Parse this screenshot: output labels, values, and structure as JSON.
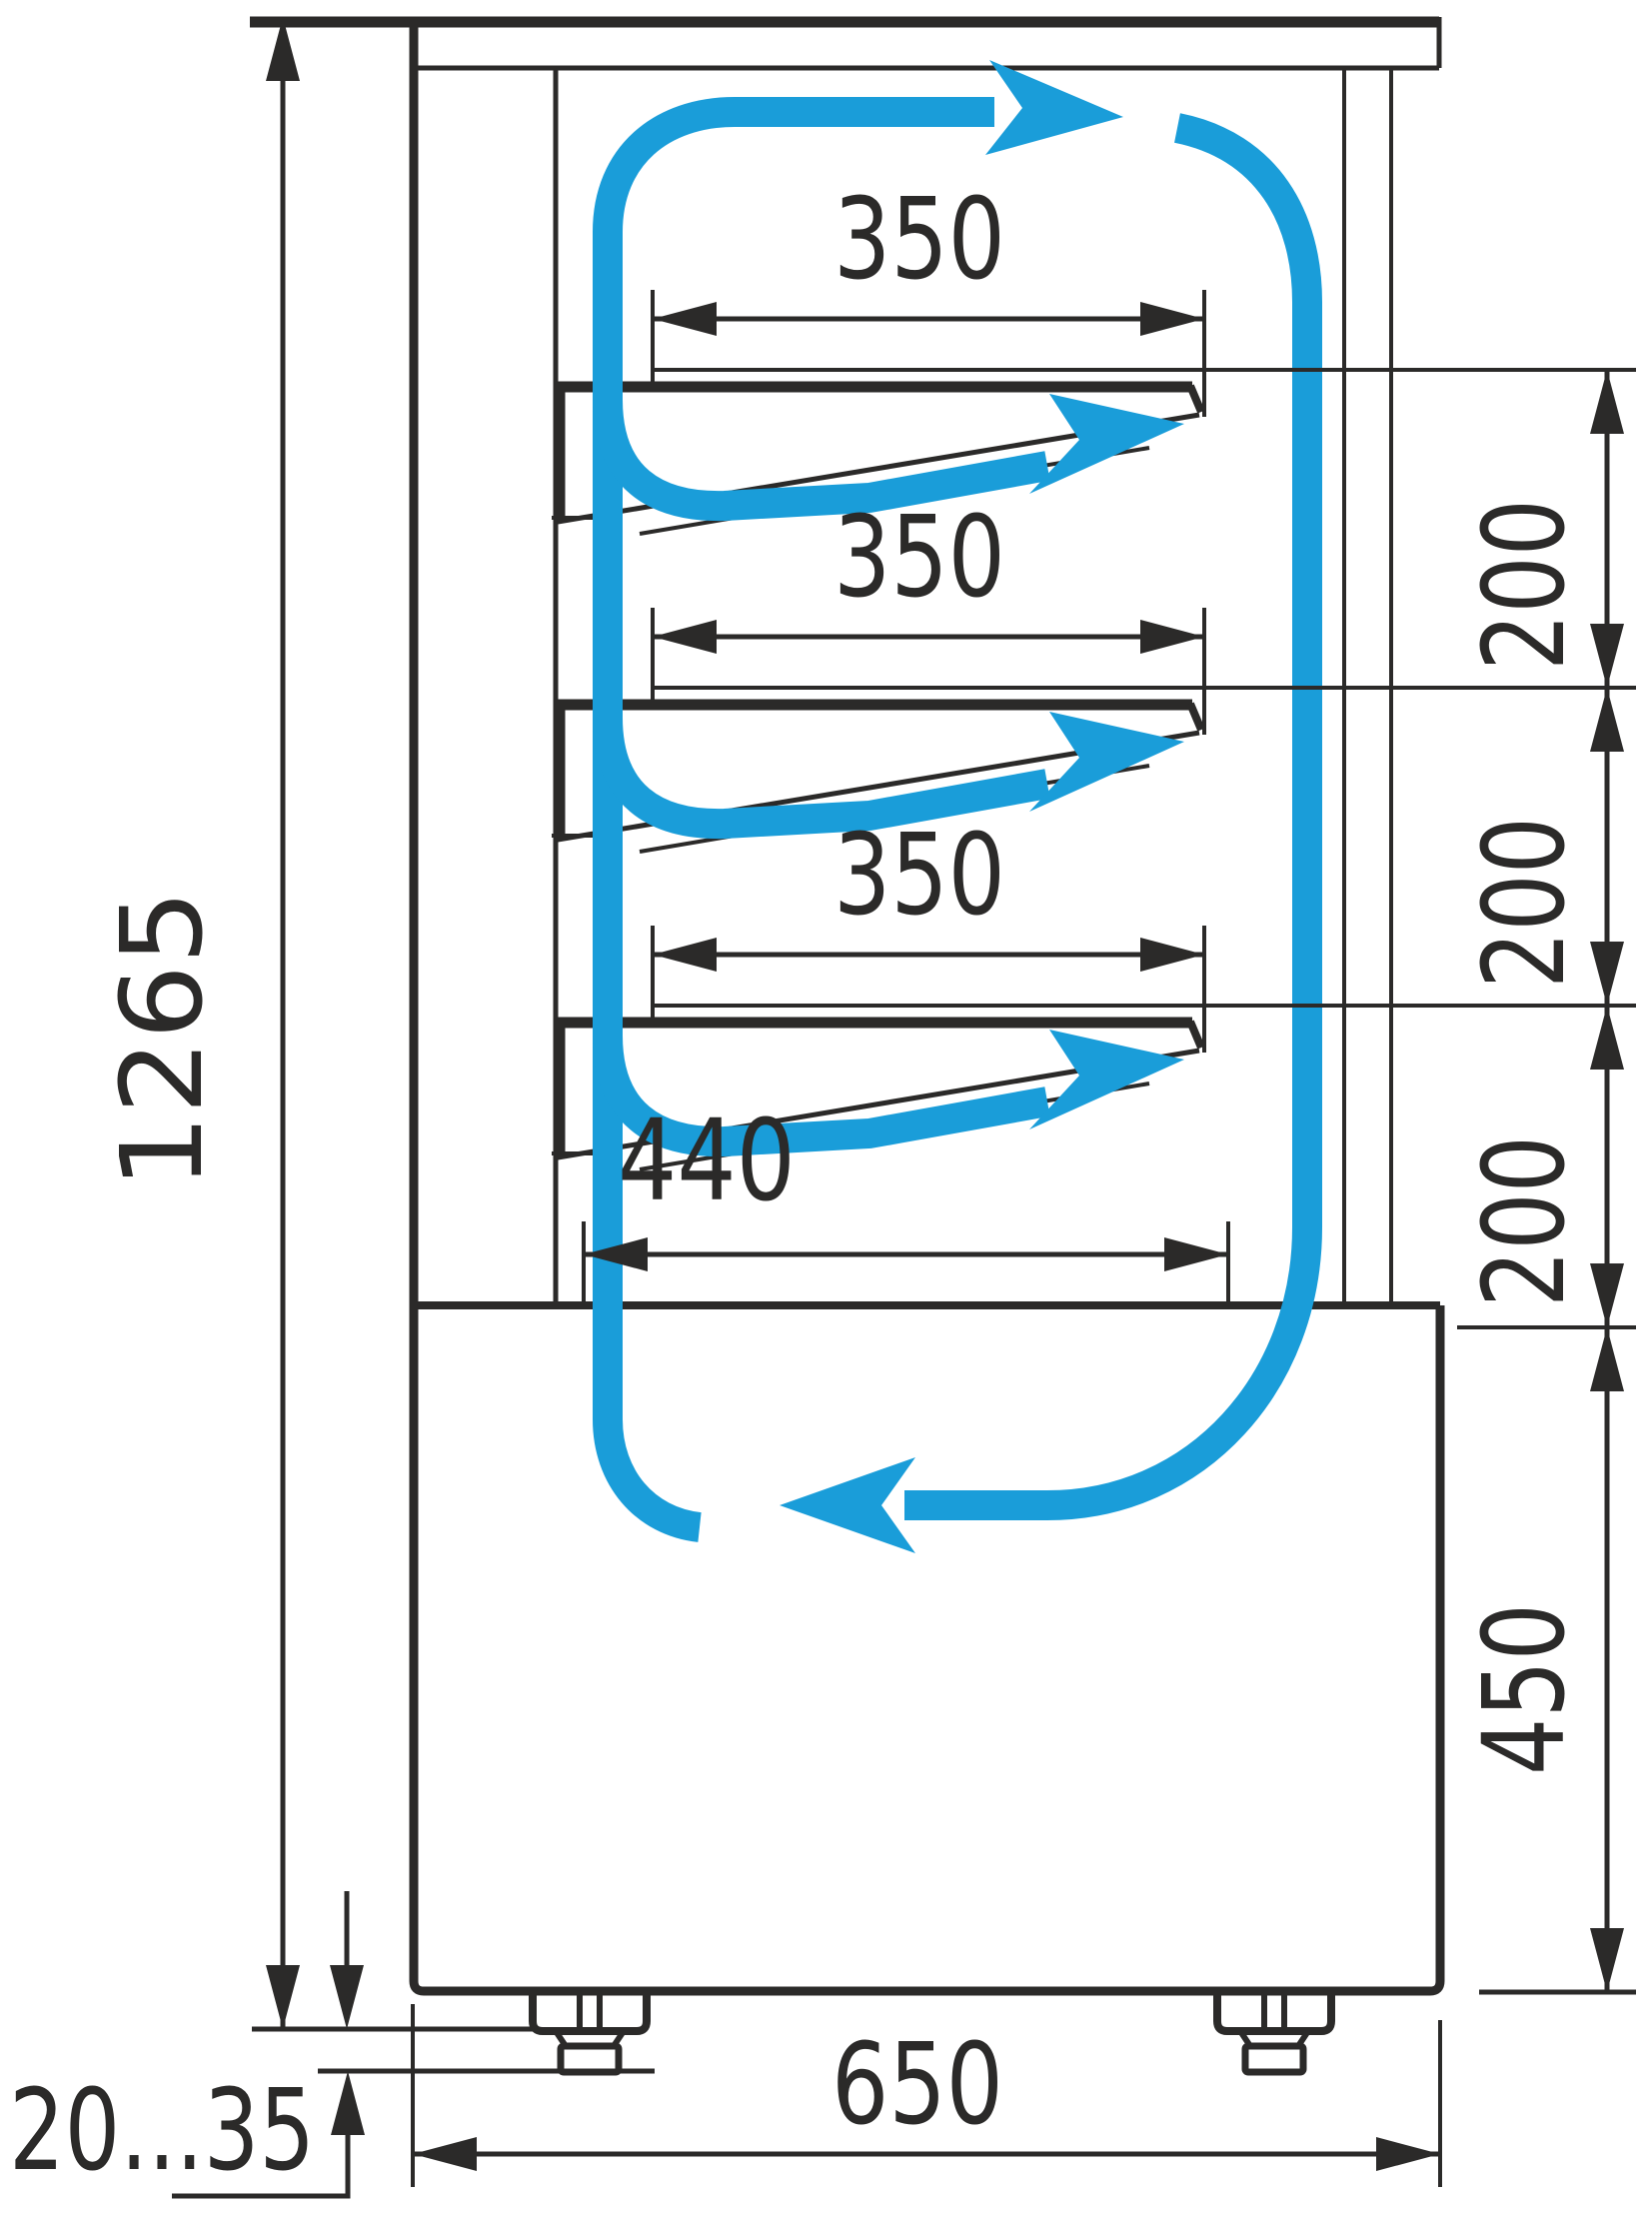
{
  "drawing": {
    "type": "technical-dimension-diagram",
    "subject": "refrigerated display case side cross-section with air circulation",
    "colors": {
      "line": "#2b2a29",
      "airflow": "#1a9dd9",
      "background": "#ffffff"
    }
  },
  "dimensions": {
    "overall_height": {
      "label": "1265",
      "orientation": "vertical"
    },
    "shelf_depths": [
      {
        "label": "350"
      },
      {
        "label": "350"
      },
      {
        "label": "350"
      }
    ],
    "bottom_shelf_depth": {
      "label": "440"
    },
    "shelf_spacings": [
      {
        "label": "200"
      },
      {
        "label": "200"
      },
      {
        "label": "200"
      }
    ],
    "base_height": {
      "label": "450",
      "orientation": "vertical"
    },
    "overall_depth": {
      "label": "650"
    },
    "foot_adjustment_range": {
      "label": "20...35"
    }
  }
}
